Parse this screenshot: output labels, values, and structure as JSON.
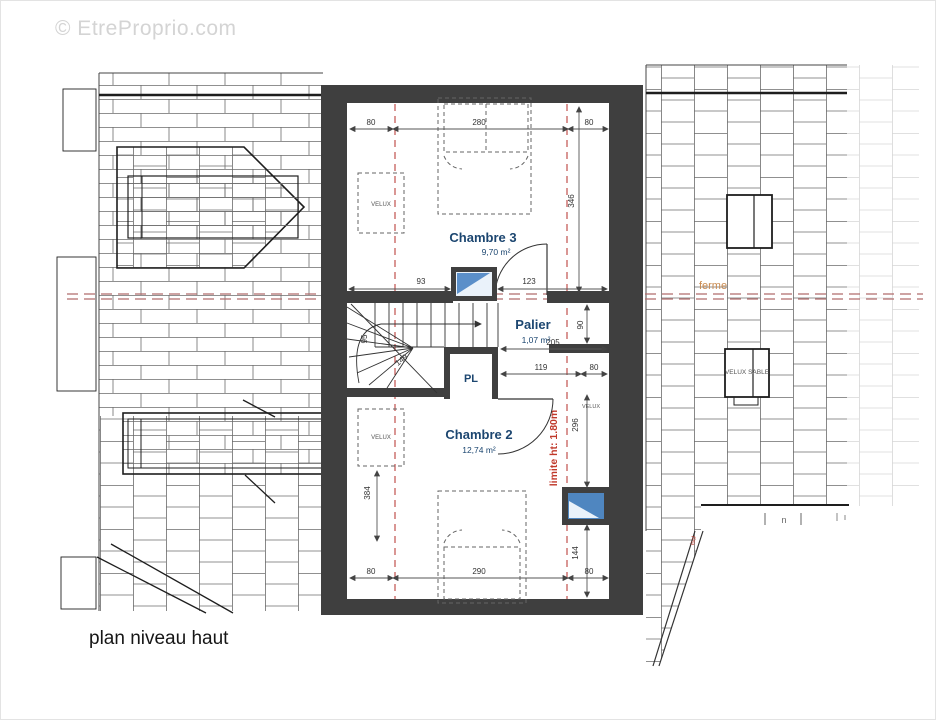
{
  "watermark": "© EtreProprio.com",
  "caption": "plan niveau haut",
  "rooms": {
    "chambre3": {
      "name": "Chambre 3",
      "area": "9,70 m²"
    },
    "palier": {
      "name": "Palier",
      "area": "1,07 m²"
    },
    "chambre2": {
      "name": "Chambre 2",
      "area": "12,74 m²"
    },
    "placard": {
      "label": "PL"
    }
  },
  "annotations": {
    "ferme": "ferme",
    "limite_hauteur": "limite ht: 1.80m",
    "velux": "VELUX",
    "velux_sable": "VELUX SABLE",
    "isol": "isol",
    "n_mark": "n"
  },
  "dimensions": {
    "top": [
      "80",
      "280",
      "80"
    ],
    "bottom": [
      "80",
      "290",
      "80"
    ],
    "chambre3_window_left": "93",
    "chambre3_window_right": "123",
    "height_346": "346",
    "height_90": "90",
    "width_205": "205",
    "width_119": "119",
    "width_80": "80",
    "height_296": "296",
    "height_144": "144",
    "height_384": "384",
    "stair_95": "95",
    "stair_149": "149"
  },
  "colors": {
    "wall": "#3f3f3f",
    "room_label": "#1c4670",
    "axis_red": "#b06c6c",
    "limit_red": "#c0392b",
    "ferme_orange": "#c8894e",
    "glazing_blue": "#4f86c0"
  }
}
